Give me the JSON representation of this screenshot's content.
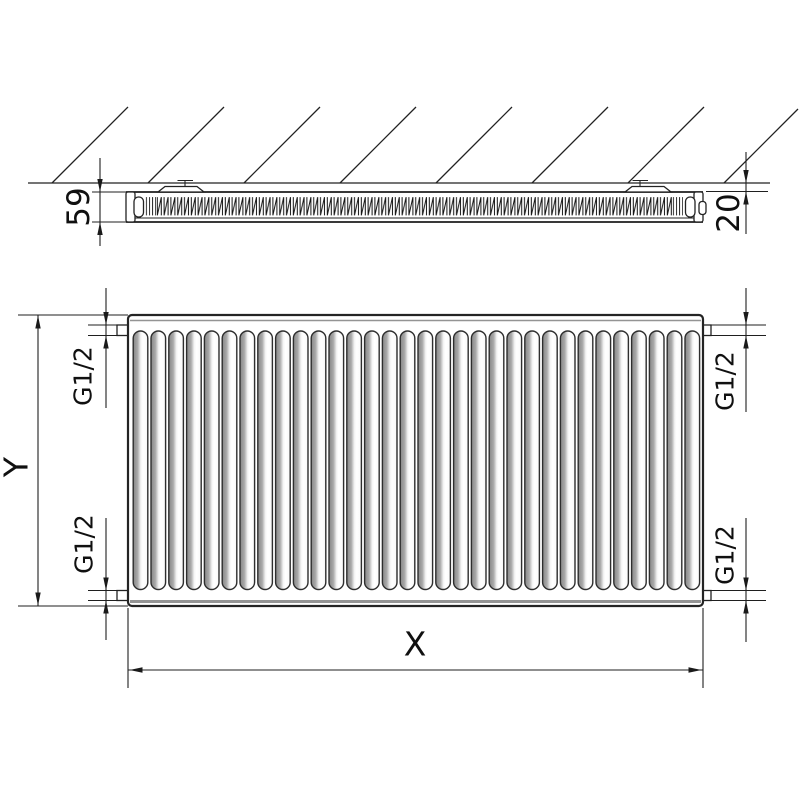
{
  "drawing": {
    "title": "panel radiator dimension drawing",
    "top_view": {
      "depth_dim": "59",
      "wall_distance_dim": "20"
    },
    "front_view": {
      "width_dim": "X",
      "height_dim": "Y",
      "rib_count": 32,
      "connections": {
        "top_left": "G1/2",
        "bottom_left": "G1/2",
        "top_right": "G1/2",
        "bottom_right": "G1/2"
      }
    },
    "colors": {
      "line": "#222222",
      "rib_shade": "#8a8a8a",
      "background": "#ffffff"
    }
  }
}
